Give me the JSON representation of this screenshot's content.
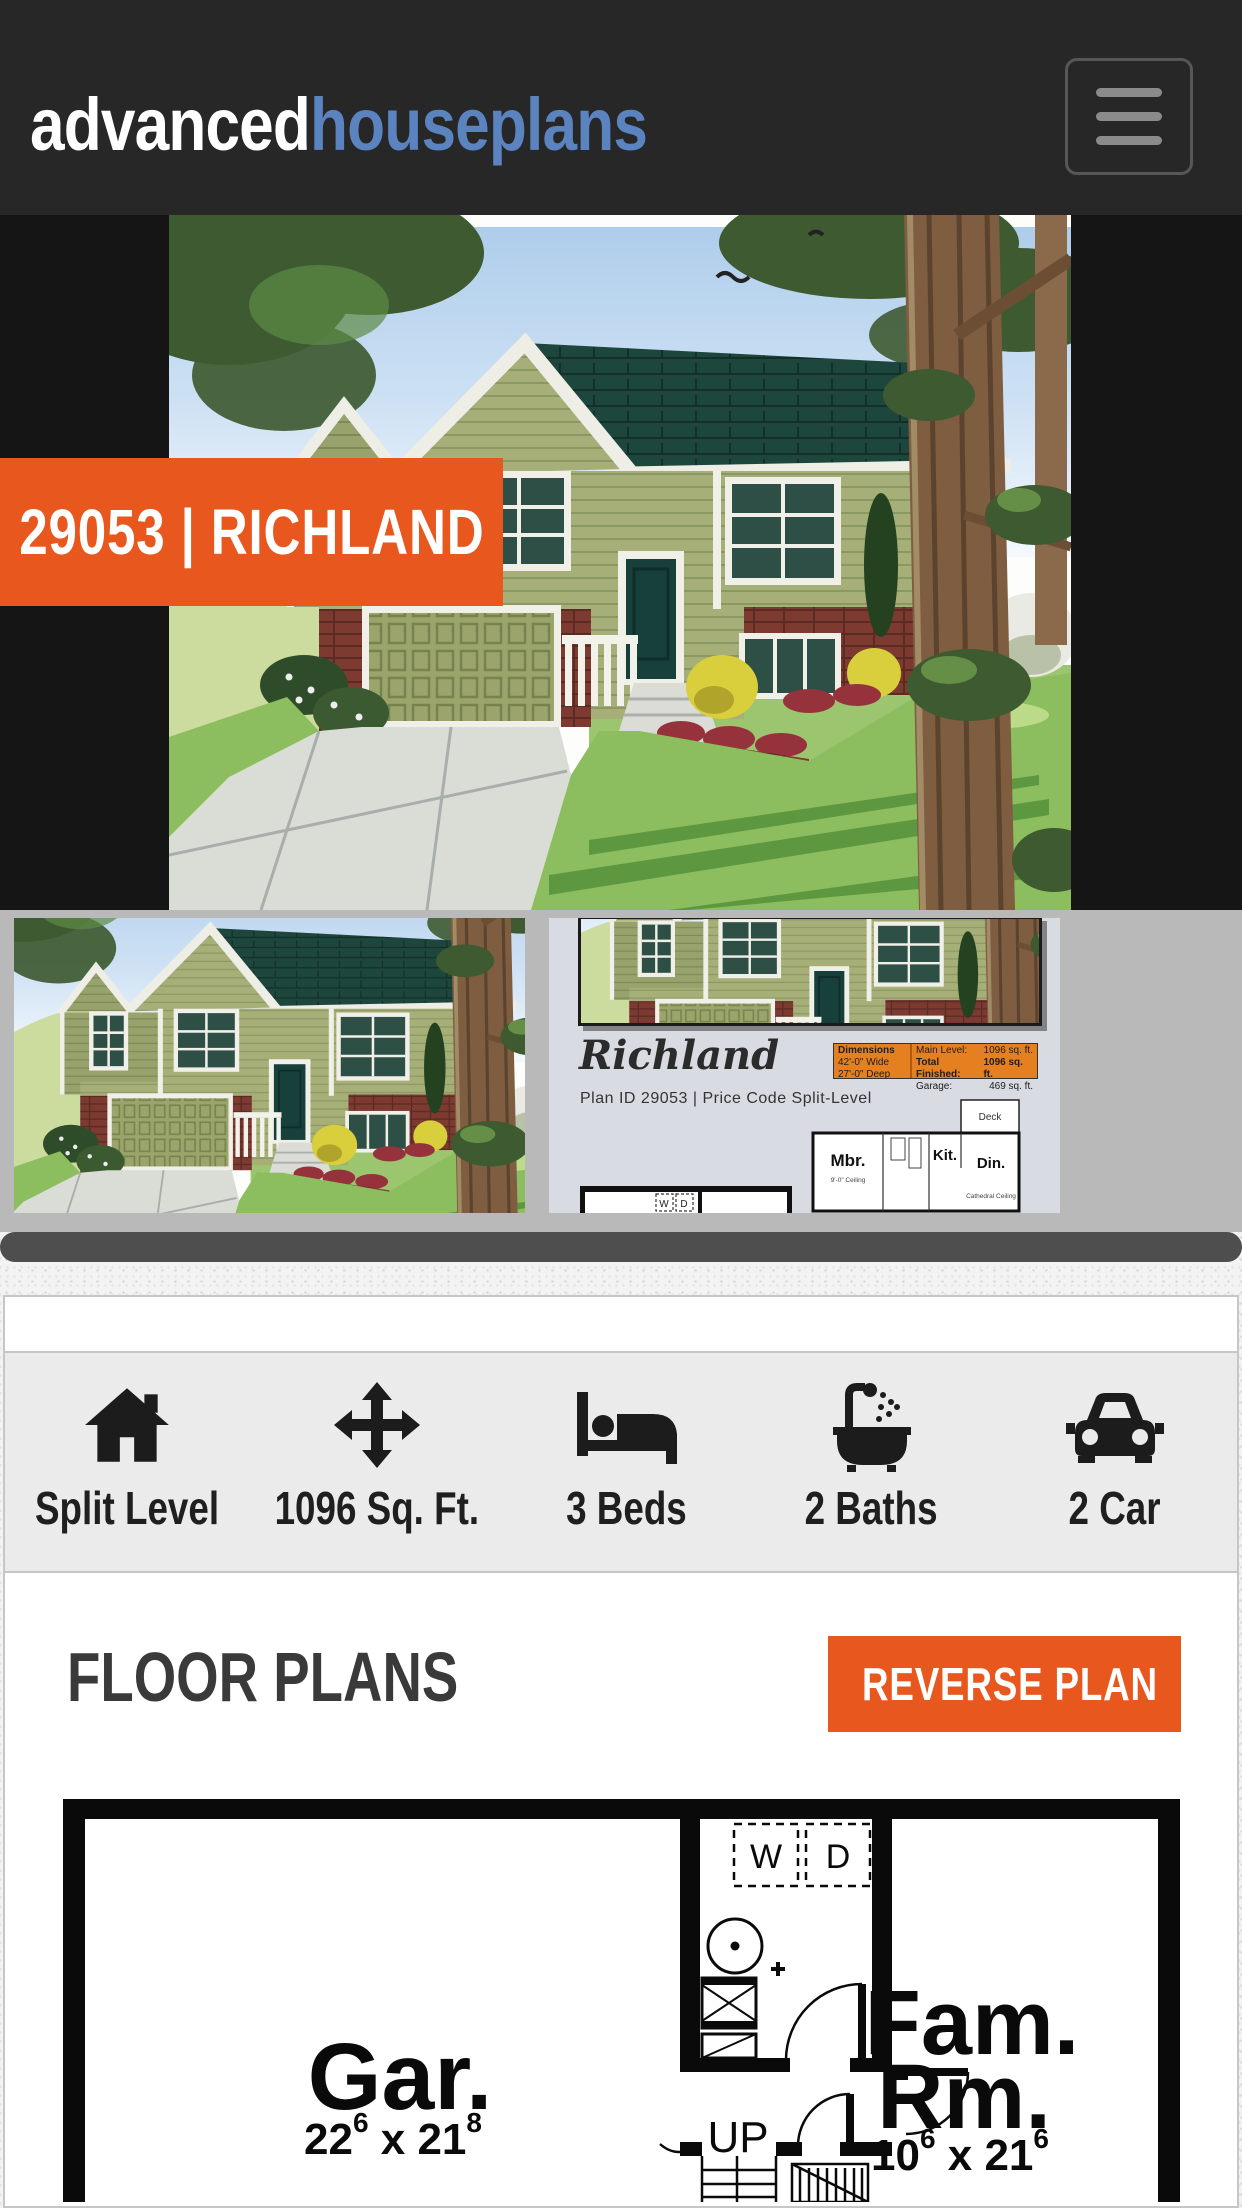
{
  "colors": {
    "accent_orange": "#E7571E",
    "navbar_bg": "#272727",
    "hero_bg": "#151515",
    "logo_blue": "#5B83BF",
    "thumbs_bg": "#B9B9B9",
    "scrollbar_thumb": "#4E4E4E",
    "panel_gray": "#EBEBEB",
    "roof_teal": "#1D473D",
    "siding_olive": "#A2AB74",
    "brick_red": "#7C3A31"
  },
  "navbar": {
    "logo_primary": "advanced",
    "logo_secondary": "houseplans"
  },
  "hero": {
    "badge": "29053 | RICHLAND"
  },
  "features": [
    {
      "icon": "home-icon",
      "label": "Split Level"
    },
    {
      "icon": "move-arrows-icon",
      "label": "1096 Sq. Ft."
    },
    {
      "icon": "bed-icon",
      "label": "3 Beds"
    },
    {
      "icon": "bath-icon",
      "label": "2 Baths"
    },
    {
      "icon": "car-icon",
      "label": "2 Car"
    }
  ],
  "floor_plans": {
    "title": "FLOOR PLANS",
    "reverse_button": "REVERSE PLAN",
    "plan": {
      "garage_label": "Gar.",
      "garage_dim": {
        "n1": "22",
        "s1": "6",
        "mid": " x 21",
        "s2": "8"
      },
      "family_label1": "Fam.",
      "family_label2": "Rm.",
      "family_dim": {
        "n1": "10",
        "s1": "6",
        "mid": " x 21",
        "s2": "6"
      },
      "washer": "W",
      "dryer": "D",
      "up": "UP"
    }
  },
  "sheet": {
    "script_title": "Richland",
    "plan_line": "Plan ID 29053 | Price Code Split-Level",
    "table": {
      "header": "Dimensions",
      "dim1": "42'-0\" Wide",
      "dim2": "27'-0\" Deep",
      "rows": [
        {
          "label": "Main Level:",
          "value": "1096 sq. ft."
        },
        {
          "label": "Total Finished:",
          "value": "1096 sq. ft."
        },
        {
          "label": "Garage:",
          "value": "469 sq. ft."
        }
      ]
    },
    "mini": {
      "mbr": "Mbr.",
      "kit": "Kit.",
      "din": "Din.",
      "deck": "Deck",
      "ceiling1": "9'-0\" Ceiling",
      "ceiling2": "Cathedral Ceiling",
      "w": "W",
      "d": "D"
    }
  }
}
